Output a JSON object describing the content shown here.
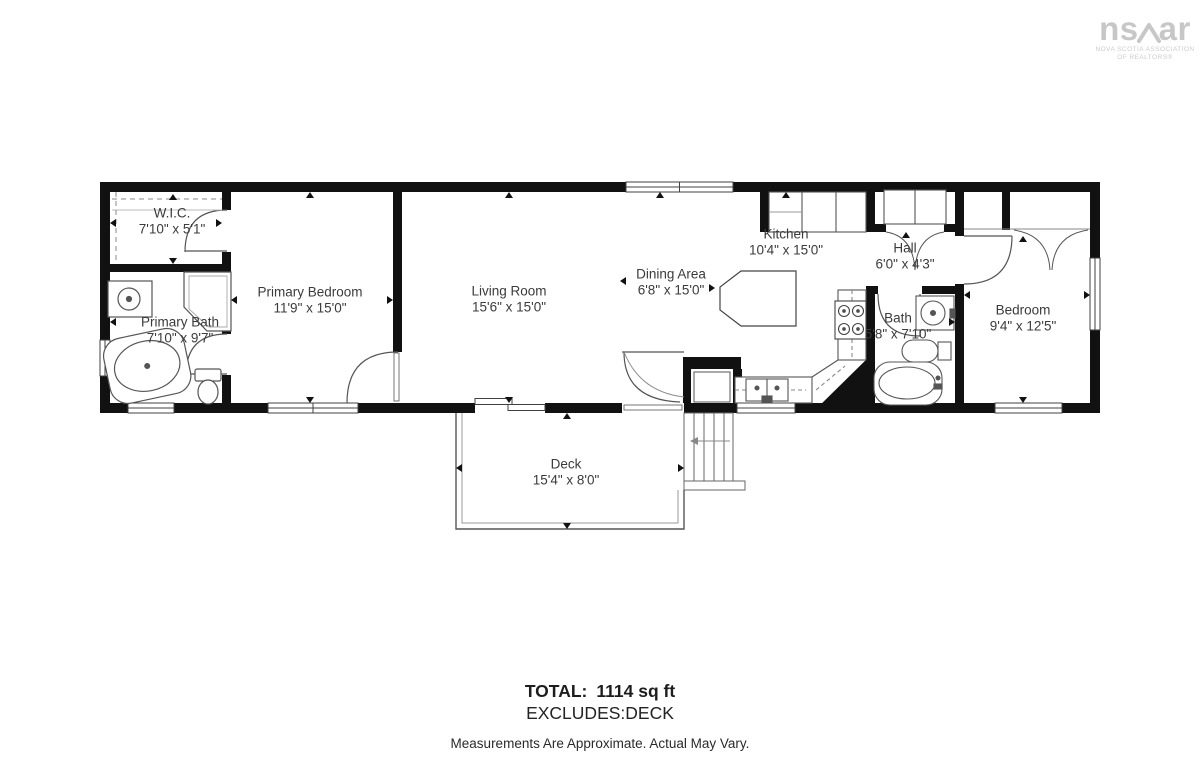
{
  "branding": {
    "name_left": "ns",
    "name_right": "ar",
    "tagline_line1": "NOVA SCOTIA ASSOCIATION",
    "tagline_line2": "OF REALTORS®"
  },
  "rooms": [
    {
      "id": "wic",
      "name": "W.I.C.",
      "dims": "7'10\" x 5'1\""
    },
    {
      "id": "primary-bath",
      "name": "Primary Bath",
      "dims": "7'10\" x 9'7\""
    },
    {
      "id": "primary-bedroom",
      "name": "Primary Bedroom",
      "dims": "11'9\" x 15'0\""
    },
    {
      "id": "living-room",
      "name": "Living Room",
      "dims": "15'6\" x 15'0\""
    },
    {
      "id": "dining-area",
      "name": "Dining Area",
      "dims": "6'8\" x 15'0\""
    },
    {
      "id": "kitchen",
      "name": "Kitchen",
      "dims": "10'4\" x 15'0\""
    },
    {
      "id": "hall",
      "name": "Hall",
      "dims": "6'0\" x 4'3\""
    },
    {
      "id": "bath",
      "name": "Bath",
      "dims": "5'8\" x 7'10\""
    },
    {
      "id": "bedroom",
      "name": "Bedroom",
      "dims": "9'4\" x 12'5\""
    },
    {
      "id": "deck",
      "name": "Deck",
      "dims": "15'4\" x 8'0\""
    }
  ],
  "summary": {
    "total_label": "TOTAL:",
    "total_value": "1114 sq ft",
    "excludes": "EXCLUDES:DECK",
    "disclaimer": "Measurements Are Approximate. Actual May Vary."
  },
  "colors": {
    "wall": "#111111",
    "fixture_line": "#555555",
    "label_text": "#3b3b3b",
    "logo_gray": "#c7c7c7"
  }
}
